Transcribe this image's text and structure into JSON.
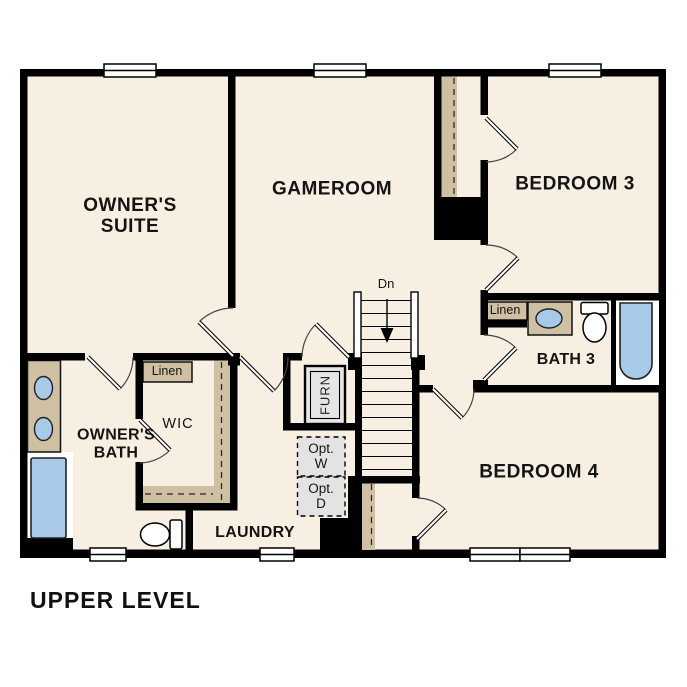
{
  "plan": {
    "title": "UPPER LEVEL",
    "rooms": {
      "owners_suite": {
        "line1": "OWNER'S",
        "line2": "SUITE"
      },
      "gameroom": "GAMEROOM",
      "bedroom3": "BEDROOM 3",
      "bath3": "BATH 3",
      "bedroom4": "BEDROOM 4",
      "owners_bath": {
        "line1": "OWNER'S",
        "line2": "BATH"
      },
      "wic": "WIC",
      "laundry": "LAUNDRY"
    },
    "labels": {
      "stair_direction": "Dn",
      "furnace": "FURN",
      "opt_washer": {
        "line1": "Opt.",
        "line2": "W"
      },
      "opt_dryer": {
        "line1": "Opt.",
        "line2": "D"
      },
      "linen_closet_hall": "Linen",
      "linen_closet_bath3": "Linen"
    },
    "colors": {
      "walls": "#000000",
      "floor": "#f7efe2",
      "casework_tan": "#cfc0a4",
      "fixture_blue": "#a9c9e9",
      "equipment_gray": "#e6e6e6",
      "background": "#ffffff"
    }
  }
}
